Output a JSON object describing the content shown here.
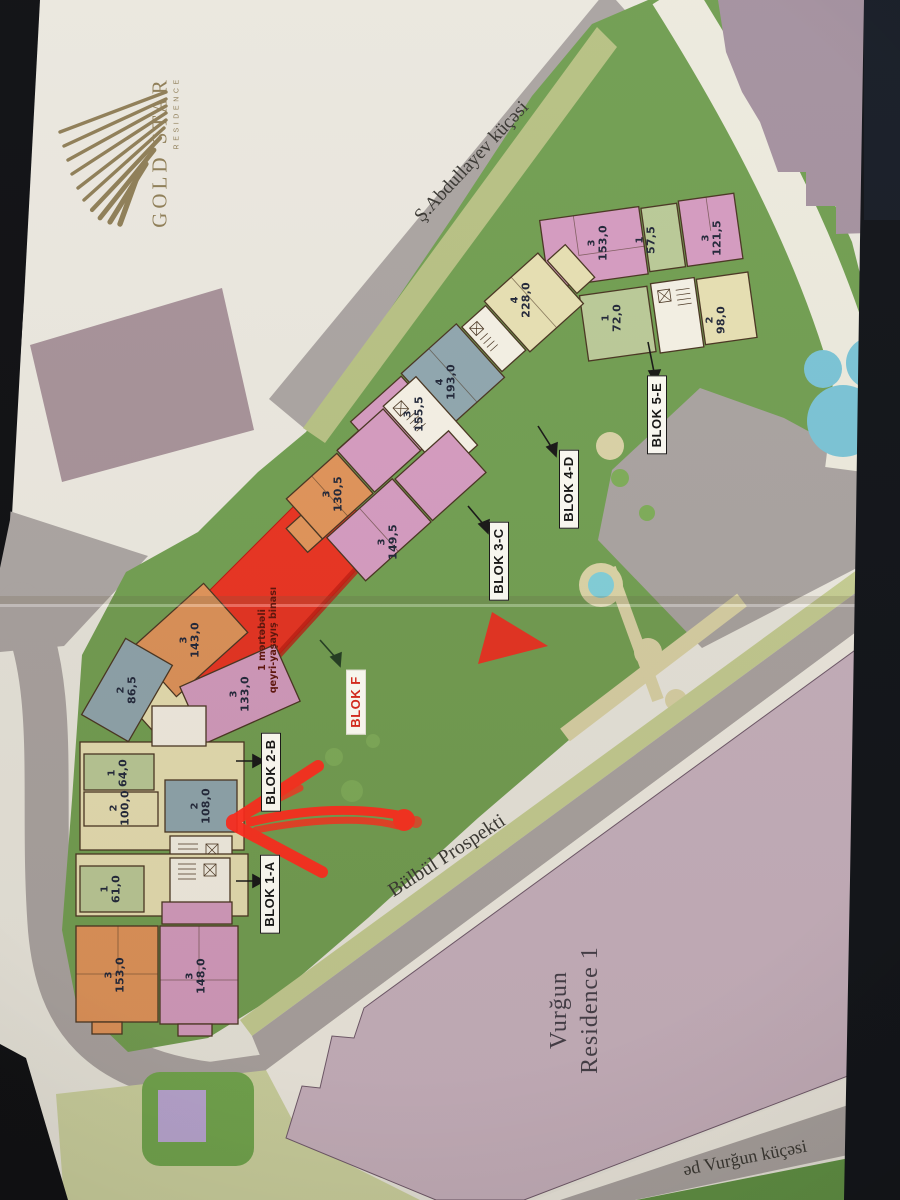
{
  "logo": {
    "title": "GOLD STAR",
    "subtitle": "RESIDENCE"
  },
  "streets": {
    "top": "Ş.Abdullayev küçəsi",
    "main": "Bülbül Prospekti",
    "bottom": "əd Vurğun küçəsi"
  },
  "neighbor_building": {
    "line1": "Vurğun",
    "line2": "Residence 1"
  },
  "non_residential_note": {
    "line1": "1 mərtəbəli",
    "line2": "qeyri-yaşayış binası"
  },
  "blocks": [
    {
      "label": "BLOK 1-A"
    },
    {
      "label": "BLOK 2-B"
    },
    {
      "label": "BLOK 3-C"
    },
    {
      "label": "BLOK 4-D"
    },
    {
      "label": "BLOK 5-E"
    },
    {
      "label": "BLOK F"
    }
  ],
  "units": [
    {
      "block": "5-E",
      "rooms": "3",
      "area": "153,0"
    },
    {
      "block": "5-E",
      "rooms": "1",
      "area": "57,5"
    },
    {
      "block": "5-E",
      "rooms": "3",
      "area": "121,5"
    },
    {
      "block": "5-E",
      "rooms": "1",
      "area": "72,0"
    },
    {
      "block": "5-E",
      "rooms": "2",
      "area": "98,0"
    },
    {
      "block": "4-D",
      "rooms": "4",
      "area": "228,0"
    },
    {
      "block": "4-D",
      "rooms": "4",
      "area": "193,0"
    },
    {
      "block": "4-D",
      "rooms": "3",
      "area": "155,5"
    },
    {
      "block": "3-C",
      "rooms": "3",
      "area": "130,5"
    },
    {
      "block": "3-C",
      "rooms": "3",
      "area": "149,5"
    },
    {
      "block": "2-B",
      "rooms": "3",
      "area": "143,0"
    },
    {
      "block": "2-B",
      "rooms": "2",
      "area": "86,5"
    },
    {
      "block": "2-B",
      "rooms": "3",
      "area": "133,0"
    },
    {
      "block": "2-B",
      "rooms": "1",
      "area": "64,0"
    },
    {
      "block": "2-B",
      "rooms": "2",
      "area": "100,0"
    },
    {
      "block": "1-A",
      "rooms": "2",
      "area": "108,0"
    },
    {
      "block": "1-A",
      "rooms": "1",
      "area": "61,0"
    },
    {
      "block": "1-A",
      "rooms": "3",
      "area": "153,0"
    },
    {
      "block": "1-A",
      "rooms": "3",
      "area": "148,0"
    }
  ],
  "colors": {
    "unit_pink": "#d49ac0",
    "unit_orange": "#df9258",
    "unit_green": "#b9c997",
    "unit_cream": "#e6dfb2",
    "unit_bluegray": "#8ea5ae",
    "non_residential_red": "#e8301f",
    "annotation_arrow_red": "#ff2418",
    "park_green": "#6f9d50",
    "road_gray": "#a9a3a1",
    "building_mauve": "#a3909f",
    "pond_blue": "#79c3d6",
    "logo_gold": "#8d7c55"
  }
}
